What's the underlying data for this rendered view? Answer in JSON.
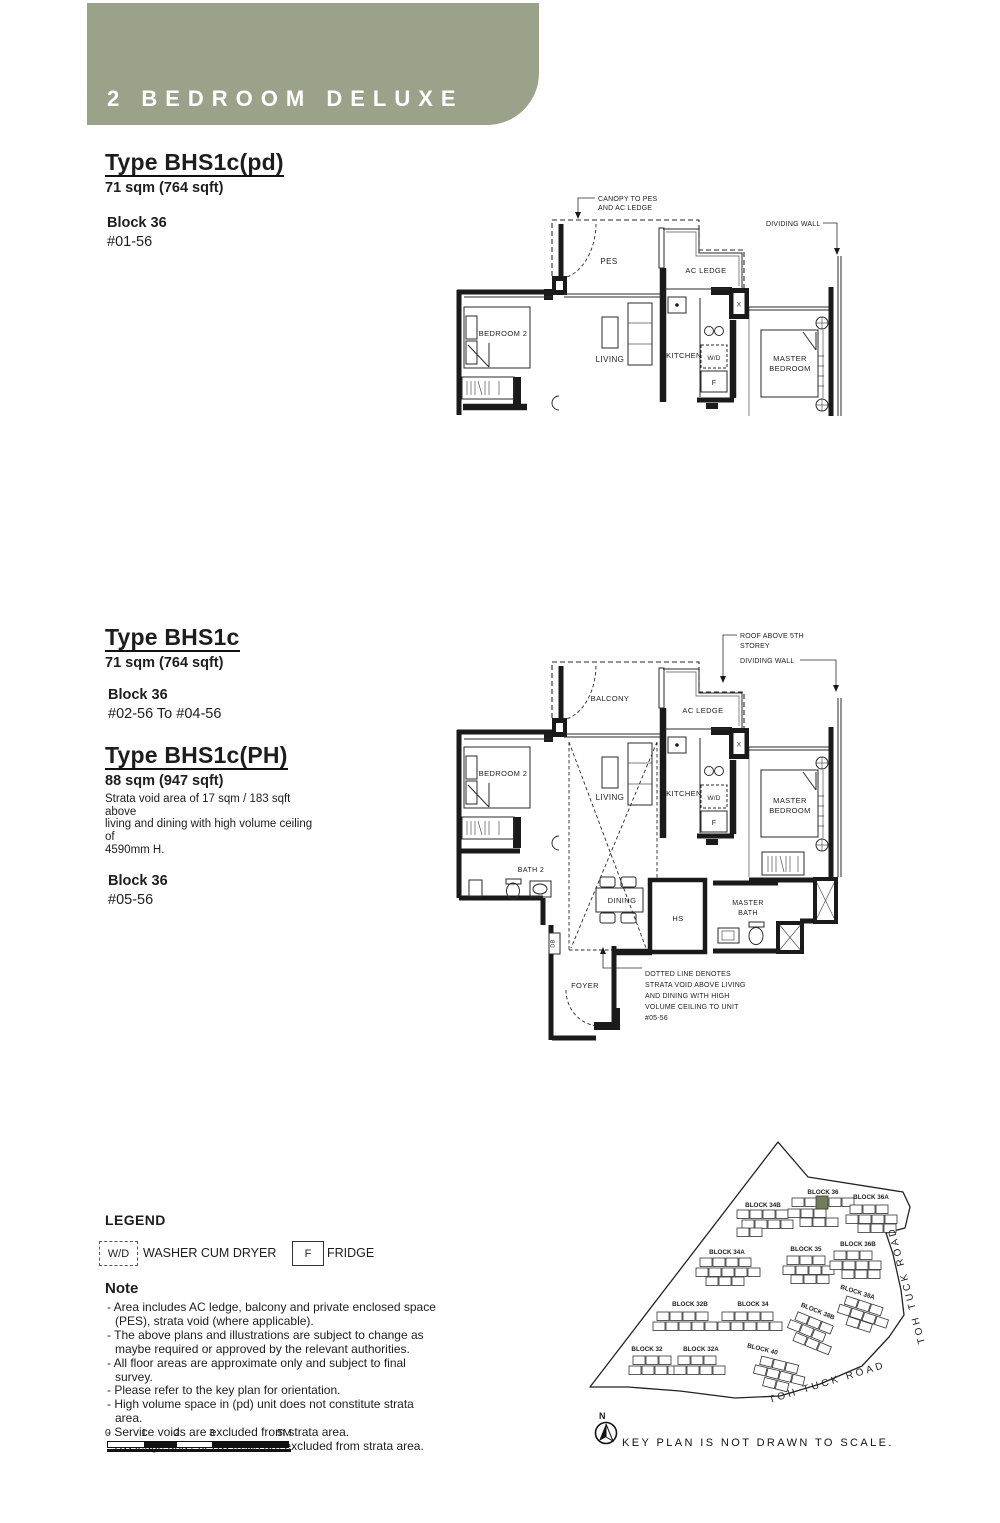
{
  "banner": {
    "title": "2 BEDROOM DELUXE",
    "bg_color": "#9aa38a",
    "text_color": "#ffffff"
  },
  "unit_pd": {
    "title": "Type BHS1c(pd)",
    "area": "71 sqm (764 sqft)",
    "block": "Block 36",
    "levels": "#01-56"
  },
  "unit_std": {
    "title": "Type BHS1c",
    "area": "71 sqm (764 sqft)",
    "block": "Block 36",
    "levels": "#02-56 To #04-56"
  },
  "unit_ph": {
    "title": "Type BHS1c(PH)",
    "area": "88 sqm (947 sqft)",
    "strata_note": [
      "Strata void area of 17 sqm / 183 sqft above",
      "living and dining with high volume ceiling of",
      "4590mm H."
    ],
    "block": "Block 36",
    "levels": "#05-56"
  },
  "plan1": {
    "canopy_note": [
      "CANOPY TO PES",
      "AND AC LEDGE"
    ],
    "dividing_wall_label": "DIVIDING WALL",
    "rooms": {
      "pes": "PES",
      "ac_ledge": "AC LEDGE",
      "bedroom2": "BEDROOM 2",
      "living": "LIVING",
      "kitchen": "KITCHEN",
      "wd": "W/D",
      "fridge": "F",
      "master_line1": "MASTER",
      "master_line2": "BEDROOM",
      "shaft": "X"
    }
  },
  "plan2": {
    "roof_note": [
      "ROOF ABOVE 5TH",
      "STOREY"
    ],
    "dividing_wall_label": "DIVIDING WALL",
    "void_note": [
      "DOTTED LINE DENOTES",
      "STRATA VOID ABOVE LIVING",
      "AND DINING WITH HIGH",
      "VOLUME CEILING TO UNIT",
      "#05-56"
    ],
    "rooms": {
      "balcony": "BALCONY",
      "ac_ledge": "AC LEDGE",
      "bedroom2": "BEDROOM 2",
      "living": "LIVING",
      "kitchen": "KITCHEN",
      "wd": "W/D",
      "fridge": "F",
      "master_line1": "MASTER",
      "master_line2": "BEDROOM",
      "bath2": "BATH 2",
      "dining": "DINING",
      "hs": "HS",
      "master_bath_line1": "MASTER",
      "master_bath_line2": "BATH",
      "db": "DB",
      "foyer": "FOYER",
      "shaft": "X"
    }
  },
  "legend": {
    "title": "LEGEND",
    "wd_symbol": "W/D",
    "wd_label": "WASHER CUM DRYER",
    "fridge_symbol": "F",
    "fridge_label": "FRIDGE"
  },
  "note": {
    "title": "Note",
    "items": [
      "- Area includes AC ledge, balcony and private enclosed space (PES), strata void (where applicable).",
      "- The above plans and illustrations are subject to change as maybe required or approved by the relevant authorities.",
      "- All floor areas are approximate only and subject to final survey.",
      "- Please refer to the key plan for orientation.",
      "- High volume space in (pd) unit does not constitute strata area.",
      "- Service voids are excluded from strata area.",
      "- RC ledge and / or RC trellis are excluded from strata area."
    ]
  },
  "scalebar": {
    "ticks": [
      "0",
      "1",
      "2",
      "3",
      "5M"
    ]
  },
  "keyplan": {
    "compass_label": "N",
    "caption": "KEY PLAN IS NOT DRAWN TO SCALE.",
    "road_bottom": "TOH TUCK ROAD",
    "road_right": "TOH TUCK ROAD",
    "highlight_color": "#727c5b",
    "blocks": {
      "b34b": "BLOCK 34B",
      "b36": "BLOCK 36",
      "b36a": "BLOCK 36A",
      "b34a": "BLOCK 34A",
      "b35": "BLOCK 35",
      "b36b": "BLOCK 36B",
      "b38a": "BLOCK 38A",
      "b32b": "BLOCK 32B",
      "b34": "BLOCK 34",
      "b38b": "BLOCK 38B",
      "b32": "BLOCK 32",
      "b32a": "BLOCK 32A",
      "b40": "BLOCK 40"
    }
  }
}
